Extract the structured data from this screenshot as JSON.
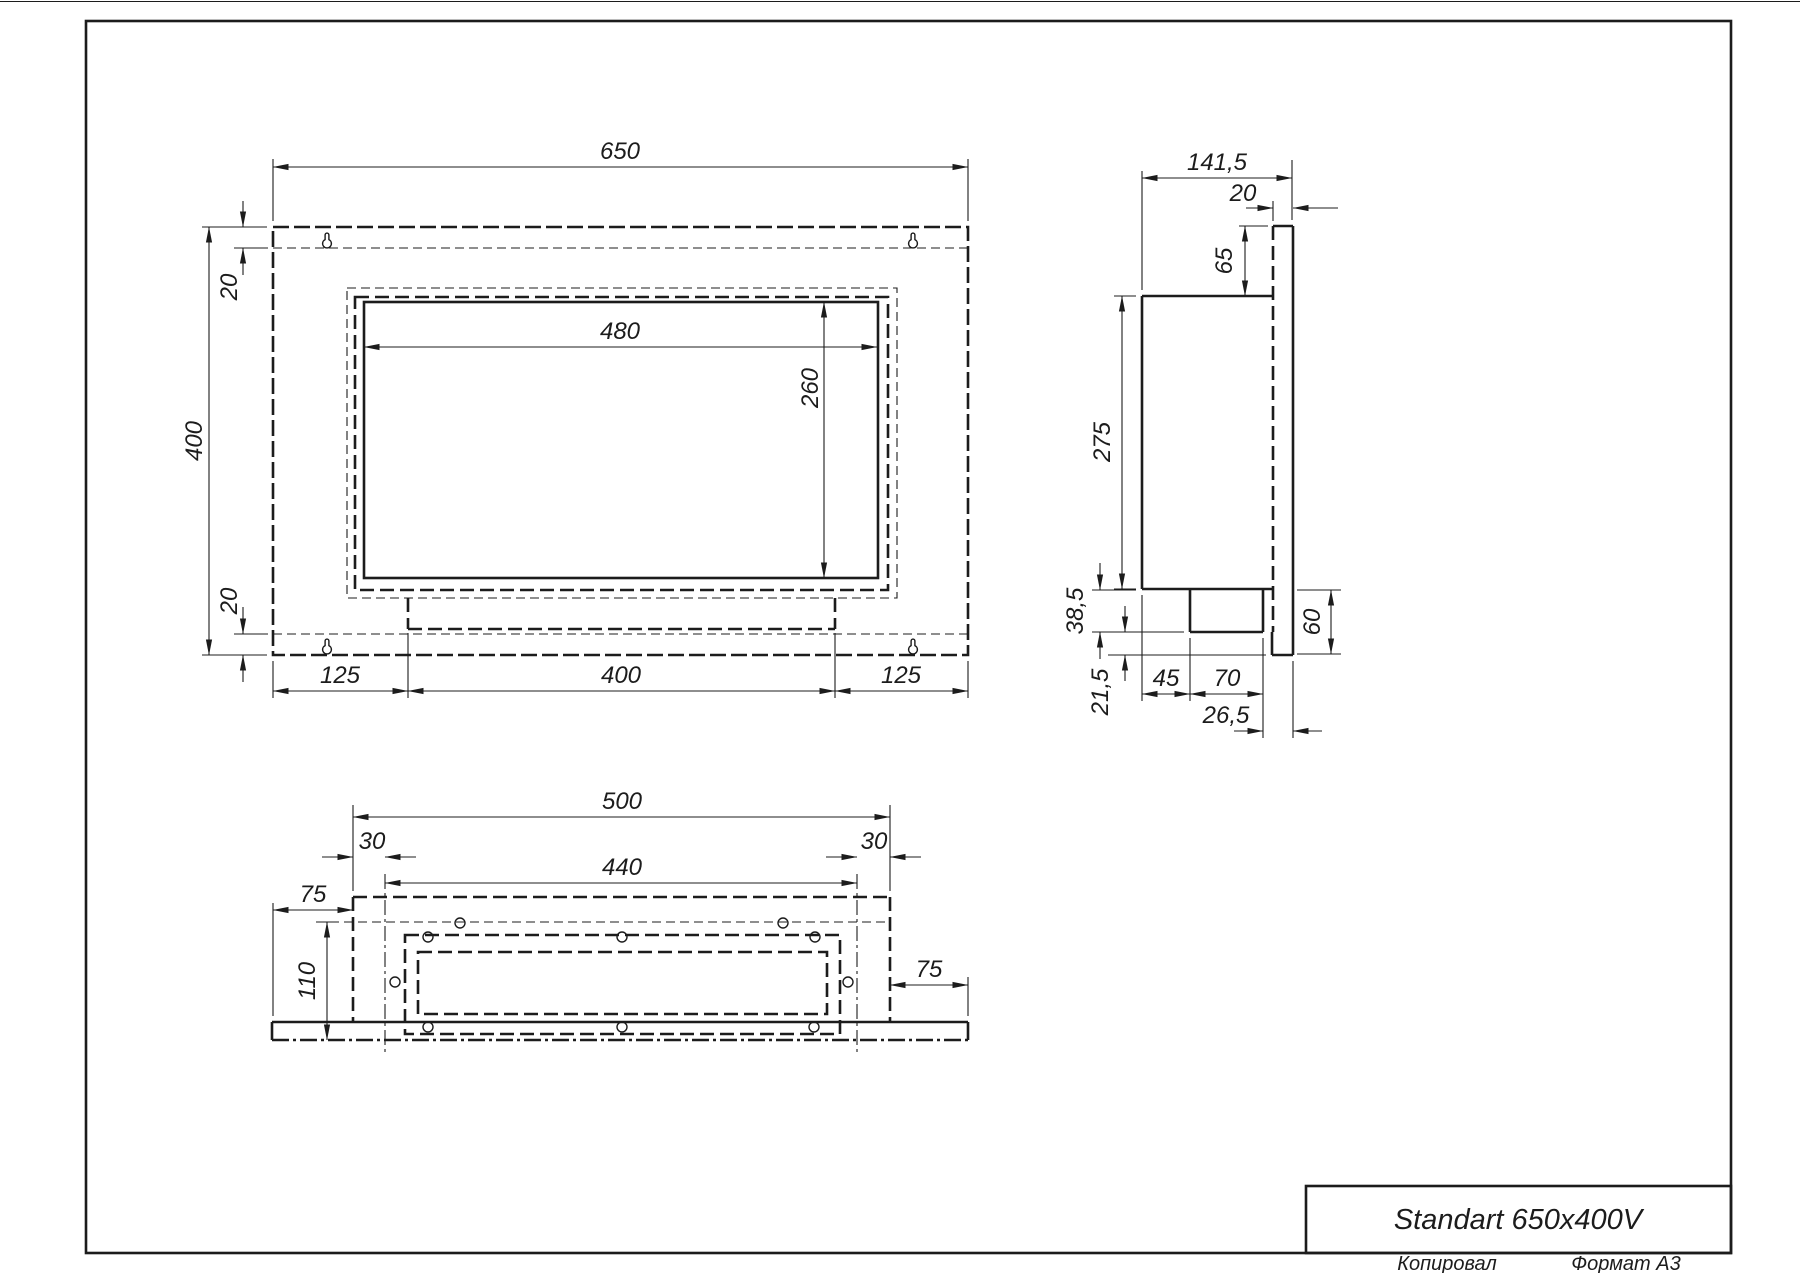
{
  "title_block": {
    "title": "Standart 650x400V",
    "stamp_left": "Копировал",
    "stamp_right": "Формат А3"
  },
  "front_view": {
    "width": "650",
    "height": "400",
    "flange_top": "20",
    "flange_bottom": "20",
    "opening_width": "480",
    "opening_height": "260",
    "margin_left": "125",
    "burner_width": "400",
    "margin_right": "125"
  },
  "side_view": {
    "depth": "141,5",
    "panel_thickness": "20",
    "top_offset": "65",
    "box_height": "275",
    "shelf_drop": "38,5",
    "lip_height": "21,5",
    "back_clearance": "45",
    "tray_depth": "70",
    "front_clearance": "26,5",
    "base_height": "60"
  },
  "bottom_view": {
    "box_width": "500",
    "hole_offset_left": "30",
    "hole_span": "440",
    "hole_offset_right": "30",
    "flange_left": "75",
    "flange_right": "75",
    "depth": "110"
  }
}
